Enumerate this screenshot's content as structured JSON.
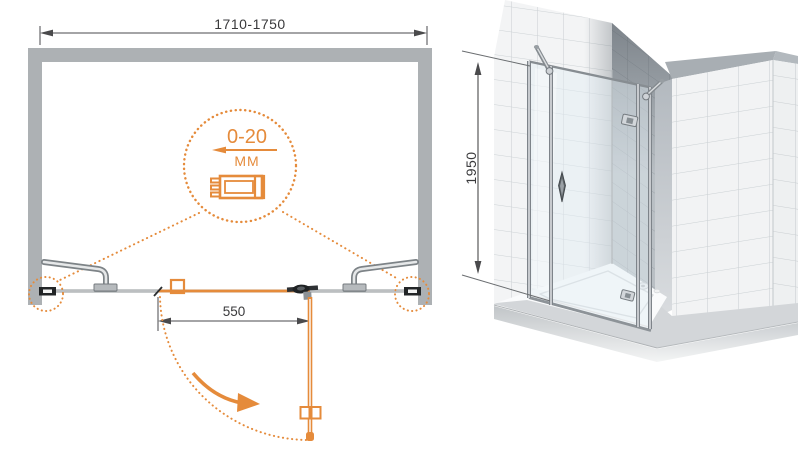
{
  "document": {
    "type": "technical-drawing",
    "subject": "shower enclosure with hinged swing door"
  },
  "plan_view": {
    "name": "top-view installation diagram",
    "width_dimension": {
      "label": "1710-1750"
    },
    "adjustment_detail": {
      "value": "0-20",
      "unit": "MM"
    },
    "door_width_dimension": {
      "label": "550"
    }
  },
  "elevation_view": {
    "name": "3d perspective view",
    "height_dimension": {
      "label": "1950"
    }
  },
  "icons": {
    "adjustment_arrow": "left-arrow",
    "swing_direction": "curved-arrow",
    "detail_callouts": "dotted-circles",
    "wall_profile": "serrated-profile-section"
  },
  "colors": {
    "accent_orange": "#E58B3B",
    "wall_gray": "#ADB1B4",
    "metal_gray": "#8A9095",
    "dimension_text": "#3A3A3C",
    "tile_fill": "#F3F4F5",
    "tile_grout": "#CCD1D4"
  }
}
